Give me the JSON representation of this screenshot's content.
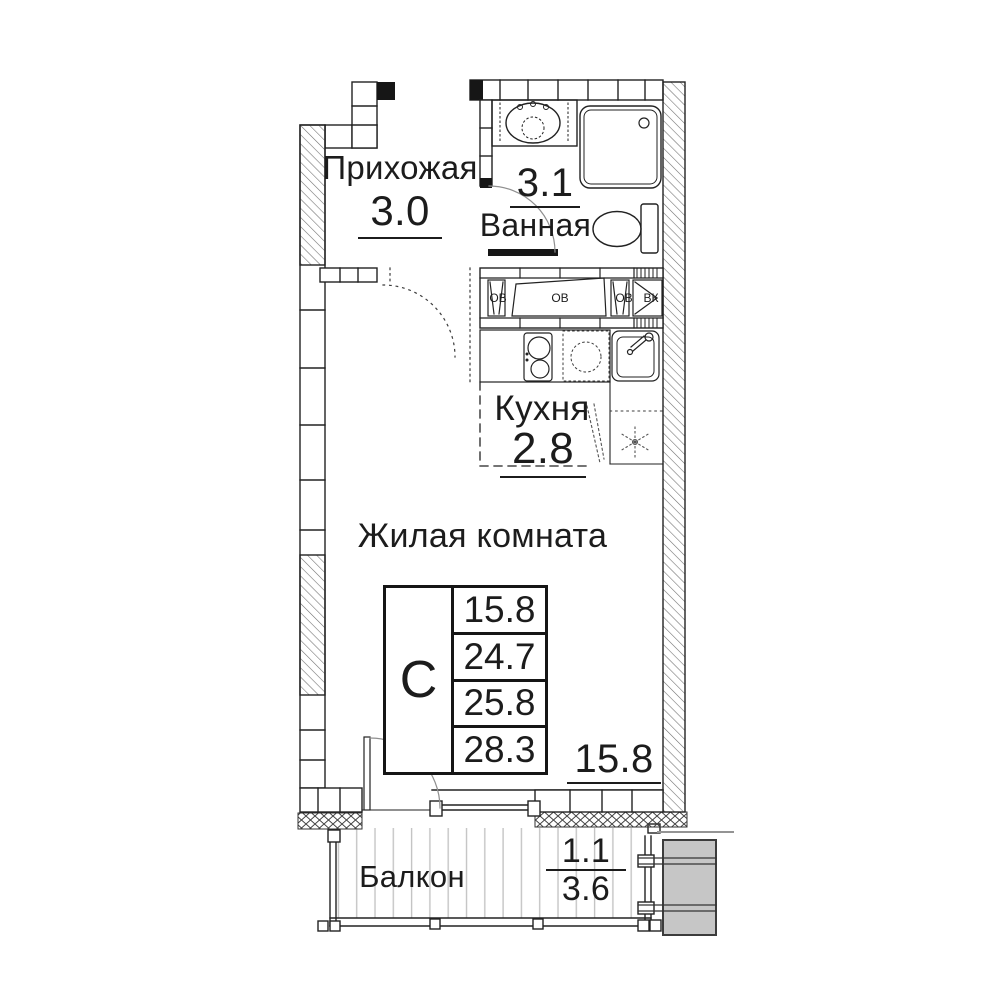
{
  "rooms": {
    "hallway": {
      "label": "Прихожая",
      "area": "3.0"
    },
    "bathroom": {
      "label": "Ванная",
      "area": "3.1"
    },
    "kitchen": {
      "label": "Кухня",
      "area": "2.8"
    },
    "living_room": {
      "label": "Жилая комната",
      "area": "15.8"
    },
    "balcony": {
      "label": "Балкон",
      "area_with_coefficient": "1.1",
      "area_full": "3.6"
    }
  },
  "summary_table": {
    "type_code": "С",
    "values": [
      "15.8",
      "24.7",
      "25.8",
      "28.3"
    ]
  },
  "shaft_labels": [
    "ОВ",
    "ОВ",
    "ОВ",
    "ВК"
  ],
  "colors": {
    "line": "#1c1c1c",
    "adjacent_block_fill": "#c6c6c6",
    "decking_line": "#c4c4c4",
    "background": "#ffffff"
  }
}
